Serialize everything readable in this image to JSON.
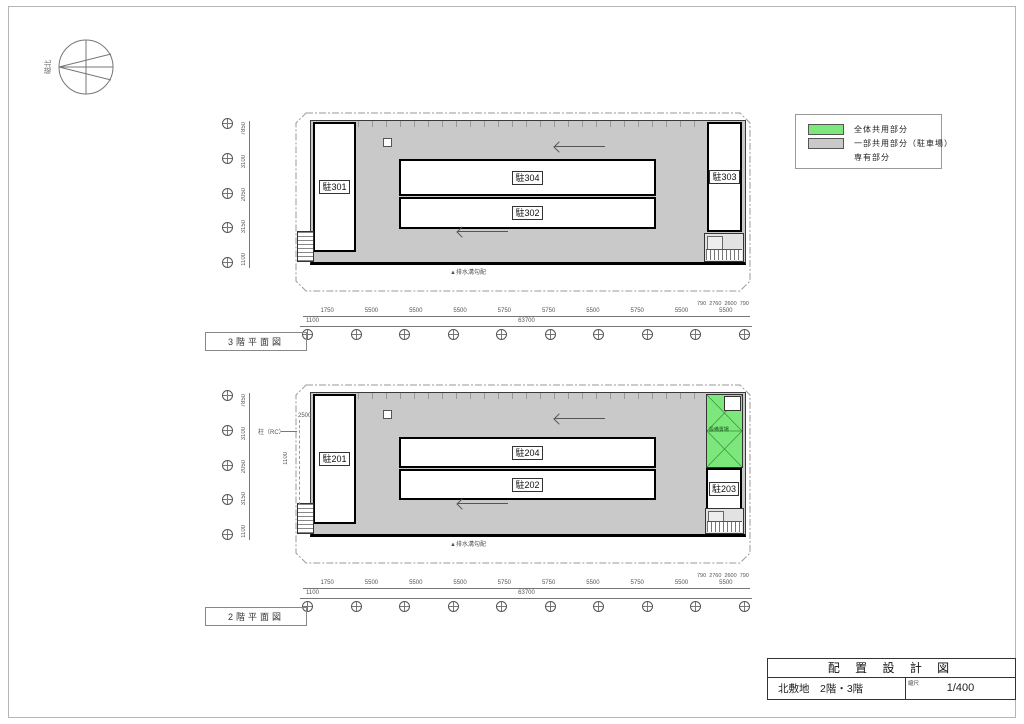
{
  "sheet": {
    "compass_label": "磁北",
    "legend": {
      "items": [
        {
          "label": "全体共用部分"
        },
        {
          "label": "一部共用部分（駐車場）"
        },
        {
          "label": "専有部分"
        }
      ],
      "colors": {
        "common_all_green": "#7ce87c",
        "common_part_gray": "#c9c9c9"
      }
    },
    "title_block": {
      "title": "配 置 設 計 図",
      "subtitle": "北敷地　2階・3階",
      "scale_label": "縮尺",
      "scale_value": "1/400"
    }
  },
  "plans": {
    "floor3": {
      "title": "3階平面図",
      "units": {
        "left": "駐301",
        "center_top": "駐304",
        "center_bottom": "駐302",
        "right": "駐303"
      },
      "drain_note": "▲排水溝勾配"
    },
    "floor2": {
      "title": "2階平面図",
      "units": {
        "left": "駐201",
        "center_top": "駐204",
        "center_bottom": "駐202",
        "right": "駐203"
      },
      "equipment_label": "設備置場",
      "column_note": "柱（RC）",
      "column_dim_top": "2500",
      "column_dim_side": "1100",
      "drain_note": "▲排水溝勾配"
    }
  },
  "dimensions": {
    "floor3": {
      "bottom_segments": [
        "1750",
        "5500",
        "5500",
        "5500",
        "5750",
        "5750",
        "5500",
        "5750",
        "5500",
        "5500"
      ],
      "bottom_total": "63700",
      "bottom_edge": "1100",
      "right_small": [
        "790",
        "2760",
        "2600",
        "790"
      ],
      "left_segments": [
        "7850",
        "3100",
        "2050",
        "3150",
        "1100"
      ]
    },
    "floor2": {
      "bottom_segments": [
        "1750",
        "5500",
        "5500",
        "5500",
        "5750",
        "5750",
        "5500",
        "5750",
        "5500",
        "5500"
      ],
      "bottom_total": "63700",
      "bottom_edge": "1100",
      "right_small": [
        "790",
        "2760",
        "2600",
        "790"
      ],
      "left_segments": [
        "7850",
        "3100",
        "2050",
        "3150",
        "1100"
      ]
    }
  }
}
